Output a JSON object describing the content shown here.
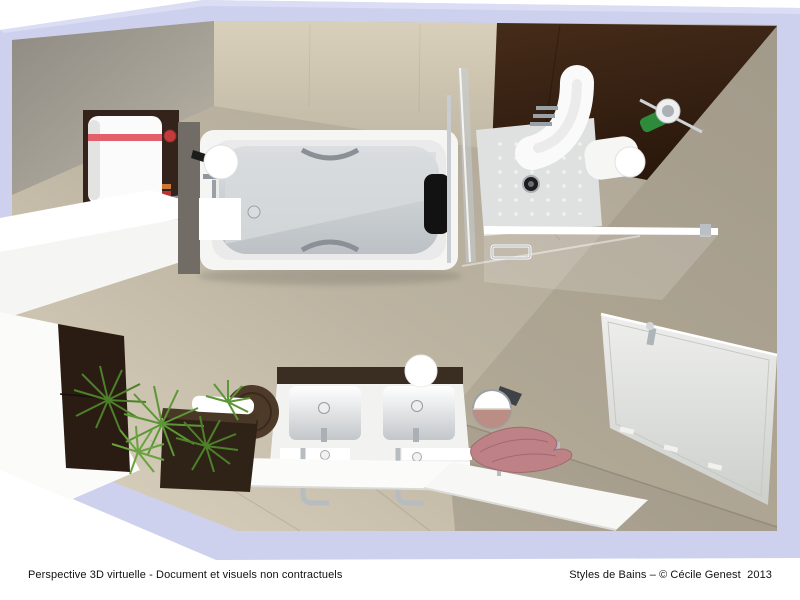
{
  "footer": {
    "disclaimer": "Perspective 3D virtuelle - Document et visuels non contractuels",
    "credit": "Styles de Bains – © Cécile Genest  2013"
  },
  "scene": {
    "type": "3d-top-view-bathroom-render",
    "elements": [
      "wall-section-band",
      "chamfer-wall",
      "north-wall",
      "brown-accent-wall",
      "east-wall",
      "tile-floor",
      "water-heater",
      "water-heater-red-stripe",
      "left-counter",
      "glass-shelf",
      "left-white-partition",
      "dark-wall-cabinet",
      "bathtub",
      "bathtub-headrest",
      "bathtub-grab-handles",
      "bathtub-faucet",
      "sphere-wall-light",
      "glass-divider",
      "shower-tray",
      "shower-drain",
      "shower-front-glass",
      "shower-door-handle",
      "shower-column",
      "shampoo-bottle",
      "corner-shelf",
      "flat-panel-radiator",
      "double-vanity",
      "basin-left",
      "basin-right",
      "floor-standing-faucets",
      "front-ledge",
      "vanity-sphere-light",
      "wenge-bench",
      "white-towel",
      "round-pouf",
      "green-plant",
      "round-mirror",
      "pink-towel",
      "towel-bench"
    ],
    "palette": {
      "wall_section": "#cdd1ee",
      "wall_beige": "#cfc6b2",
      "floor_light": "#dad2bf",
      "floor_dark": "#aaa293",
      "accent_brown": "#38220f",
      "fixture_white": "#f7f7f5",
      "tub_interior": "#c9cdd0",
      "heater_stripe": "#e2606b",
      "cabinet_wenge": "#2a1c12",
      "plant_green": "#4c8129",
      "towel_pink": "#bd8186",
      "chrome": "#9aa0a6"
    }
  }
}
